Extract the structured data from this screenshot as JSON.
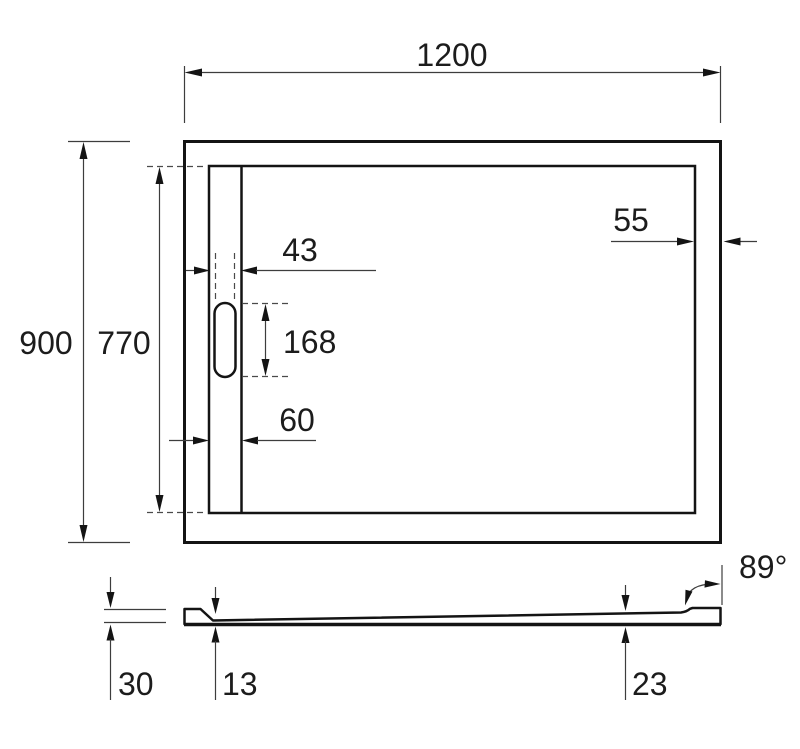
{
  "drawing": {
    "description": "Technical dimension drawing of rectangular shower tray, top view and side profile view",
    "colors": {
      "object_line": "#141414",
      "dimension_line": "#3d3d3d",
      "text": "#1c1c1c",
      "background": "#ffffff"
    },
    "top_view": {
      "labels": {
        "outer_width": "1200",
        "outer_height": "900",
        "inner_height": "770",
        "right_rim": "55",
        "drain_slot_width": "43",
        "drain_slot_length": "168",
        "left_rim": "60"
      }
    },
    "side_view": {
      "labels": {
        "total_height": "30",
        "thickness_at_drain": "13",
        "thickness_at_end": "23",
        "corner_angle": "89°"
      }
    }
  }
}
